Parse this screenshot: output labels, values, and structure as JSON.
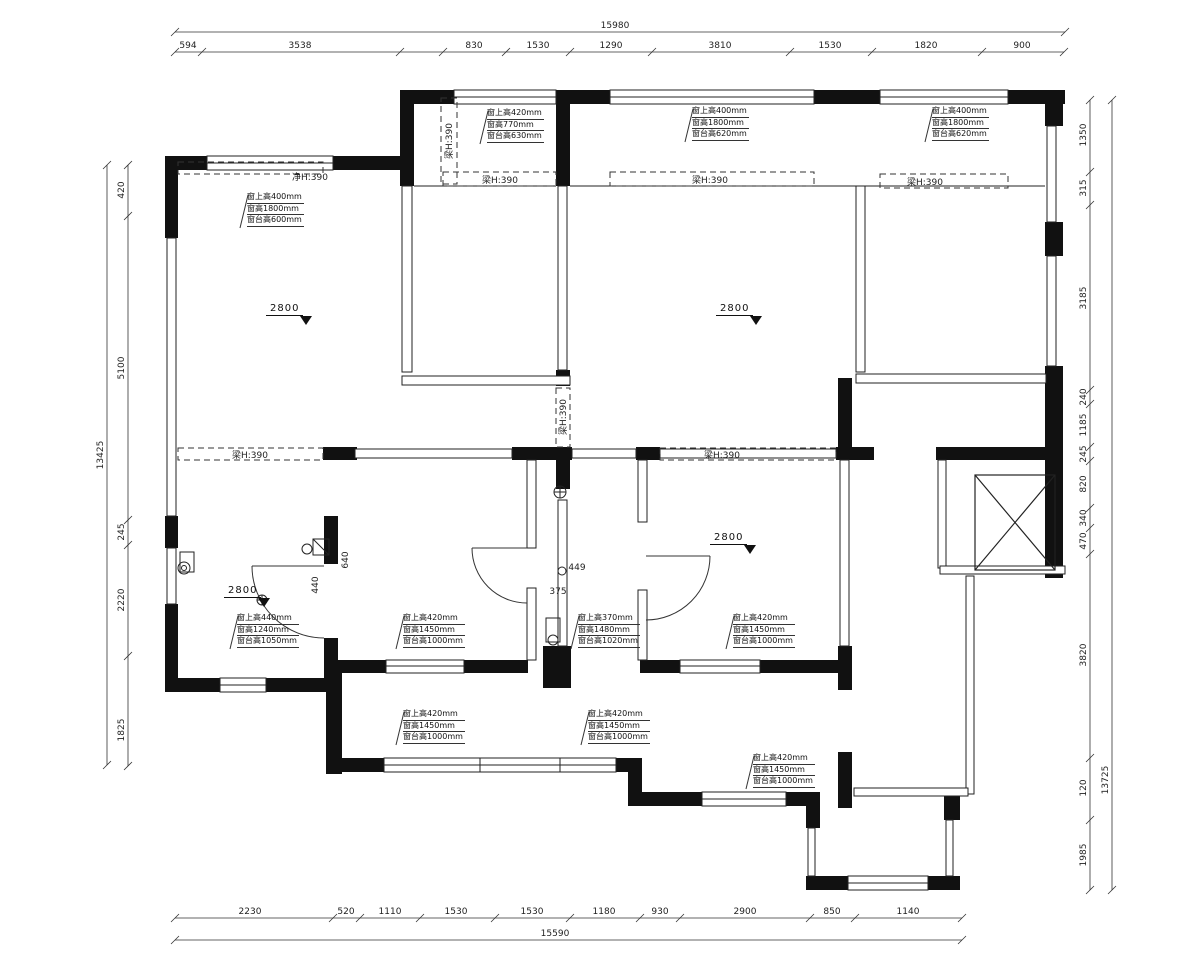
{
  "drawing": {
    "type": "residential-floor-plan",
    "line_color": "#1a1a1a",
    "wall_fill": "#111111",
    "background": "#ffffff"
  },
  "level_markers": {
    "value": "2800",
    "positions": [
      {
        "x": 266,
        "y": 303
      },
      {
        "x": 716,
        "y": 303
      },
      {
        "x": 710,
        "y": 532
      },
      {
        "x": 224,
        "y": 585
      }
    ]
  },
  "window_annotations": [
    {
      "x": 487,
      "y": 108,
      "lines": [
        "窗上高420mm",
        "窗高770mm",
        "窗台高630mm"
      ]
    },
    {
      "x": 692,
      "y": 106,
      "lines": [
        "窗上高400mm",
        "窗高1800mm",
        "窗台高620mm"
      ]
    },
    {
      "x": 932,
      "y": 106,
      "lines": [
        "窗上高400mm",
        "窗高1800mm",
        "窗台高620mm"
      ]
    },
    {
      "x": 247,
      "y": 192,
      "lines": [
        "窗上高400mm",
        "窗高1800mm",
        "窗台高600mm"
      ]
    },
    {
      "x": 237,
      "y": 613,
      "lines": [
        "窗上高440mm",
        "窗高1240mm",
        "窗台高1050mm"
      ]
    },
    {
      "x": 403,
      "y": 613,
      "lines": [
        "窗上高420mm",
        "窗高1450mm",
        "窗台高1000mm"
      ]
    },
    {
      "x": 578,
      "y": 613,
      "lines": [
        "窗上高370mm",
        "窗高1480mm",
        "窗台高1020mm"
      ]
    },
    {
      "x": 733,
      "y": 613,
      "lines": [
        "窗上高420mm",
        "窗高1450mm",
        "窗台高1000mm"
      ]
    },
    {
      "x": 403,
      "y": 709,
      "lines": [
        "窗上高420mm",
        "窗高1450mm",
        "窗台高1000mm"
      ]
    },
    {
      "x": 588,
      "y": 709,
      "lines": [
        "窗上高420mm",
        "窗高1450mm",
        "窗台高1000mm"
      ]
    },
    {
      "x": 753,
      "y": 753,
      "lines": [
        "窗上高420mm",
        "窗高1450mm",
        "窗台高1000mm"
      ]
    }
  ],
  "labels": [
    {
      "text": "净H:390",
      "x": 310,
      "y": 180,
      "rot": 0
    },
    {
      "text": "梁H:390",
      "x": 500,
      "y": 183,
      "rot": 0
    },
    {
      "text": "梁H:390",
      "x": 710,
      "y": 183,
      "rot": 0
    },
    {
      "text": "梁H:390",
      "x": 925,
      "y": 185,
      "rot": 0
    },
    {
      "text": "梁H:390",
      "x": 250,
      "y": 458,
      "rot": 0
    },
    {
      "text": "梁H:390",
      "x": 722,
      "y": 458,
      "rot": 0
    },
    {
      "text": "梁H:390",
      "x": 452,
      "y": 141,
      "rot": -90
    },
    {
      "text": "梁H:390",
      "x": 566,
      "y": 417,
      "rot": -90
    },
    {
      "text": "640",
      "x": 348,
      "y": 560,
      "rot": -90
    },
    {
      "text": "440",
      "x": 318,
      "y": 585,
      "rot": -90
    },
    {
      "text": "449",
      "x": 577,
      "y": 570,
      "rot": 0
    },
    {
      "text": "375",
      "x": 558,
      "y": 594,
      "rot": 0
    }
  ],
  "dims": {
    "chains": [
      {
        "orient": "h",
        "pos": 32,
        "ticks": [
          175,
          1065
        ],
        "labels": [
          {
            "t": "15980",
            "at": 615
          }
        ]
      },
      {
        "orient": "h",
        "pos": 52,
        "ticks": [
          175,
          202,
          400,
          443,
          506,
          570,
          652,
          790,
          872,
          982,
          1064
        ],
        "labels": [
          {
            "t": "594",
            "at": 188
          },
          {
            "t": "3538",
            "at": 300
          },
          {
            "t": "830",
            "at": 474
          },
          {
            "t": "1530",
            "at": 538
          },
          {
            "t": "1290",
            "at": 611
          },
          {
            "t": "3810",
            "at": 720
          },
          {
            "t": "1530",
            "at": 830
          },
          {
            "t": "1820",
            "at": 926
          },
          {
            "t": "900",
            "at": 1022
          }
        ]
      },
      {
        "orient": "h",
        "pos": 918,
        "ticks": [
          175,
          333,
          360,
          420,
          495,
          570,
          640,
          680,
          810,
          855,
          962
        ],
        "labels": [
          {
            "t": "2230",
            "at": 250
          },
          {
            "t": "520",
            "at": 346
          },
          {
            "t": "1110",
            "at": 390
          },
          {
            "t": "1530",
            "at": 456
          },
          {
            "t": "1530",
            "at": 532
          },
          {
            "t": "1180",
            "at": 604
          },
          {
            "t": "930",
            "at": 660
          },
          {
            "t": "2900",
            "at": 745
          },
          {
            "t": "850",
            "at": 832
          },
          {
            "t": "1140",
            "at": 908
          }
        ]
      },
      {
        "orient": "h",
        "pos": 940,
        "ticks": [
          175,
          962
        ],
        "labels": [
          {
            "t": "15590",
            "at": 555
          }
        ]
      },
      {
        "orient": "v",
        "pos": 128,
        "ticks": [
          165,
          216,
          520,
          545,
          656,
          766
        ],
        "labels": [
          {
            "t": "420",
            "at": 190
          },
          {
            "t": "5100",
            "at": 368
          },
          {
            "t": "245",
            "at": 532
          },
          {
            "t": "2220",
            "at": 600
          },
          {
            "t": "1825",
            "at": 730
          }
        ]
      },
      {
        "orient": "v",
        "pos": 107,
        "ticks": [
          165,
          765
        ],
        "labels": [
          {
            "t": "13425",
            "at": 455
          }
        ]
      },
      {
        "orient": "v",
        "pos": 1090,
        "ticks": [
          100,
          172,
          205,
          390,
          404,
          447,
          461,
          508,
          528,
          554,
          758,
          820,
          890
        ],
        "labels": [
          {
            "t": "1350",
            "at": 135
          },
          {
            "t": "315",
            "at": 188
          },
          {
            "t": "3185",
            "at": 298
          },
          {
            "t": "240",
            "at": 397
          },
          {
            "t": "1185",
            "at": 425
          },
          {
            "t": "245",
            "at": 454
          },
          {
            "t": "820",
            "at": 484
          },
          {
            "t": "340",
            "at": 518
          },
          {
            "t": "470",
            "at": 541
          },
          {
            "t": "3820",
            "at": 655
          },
          {
            "t": "120",
            "at": 788
          },
          {
            "t": "1985",
            "at": 855
          }
        ]
      },
      {
        "orient": "v",
        "pos": 1112,
        "ticks": [
          100,
          890
        ],
        "labels": [
          {
            "t": "13725",
            "at": 780
          }
        ]
      }
    ]
  }
}
